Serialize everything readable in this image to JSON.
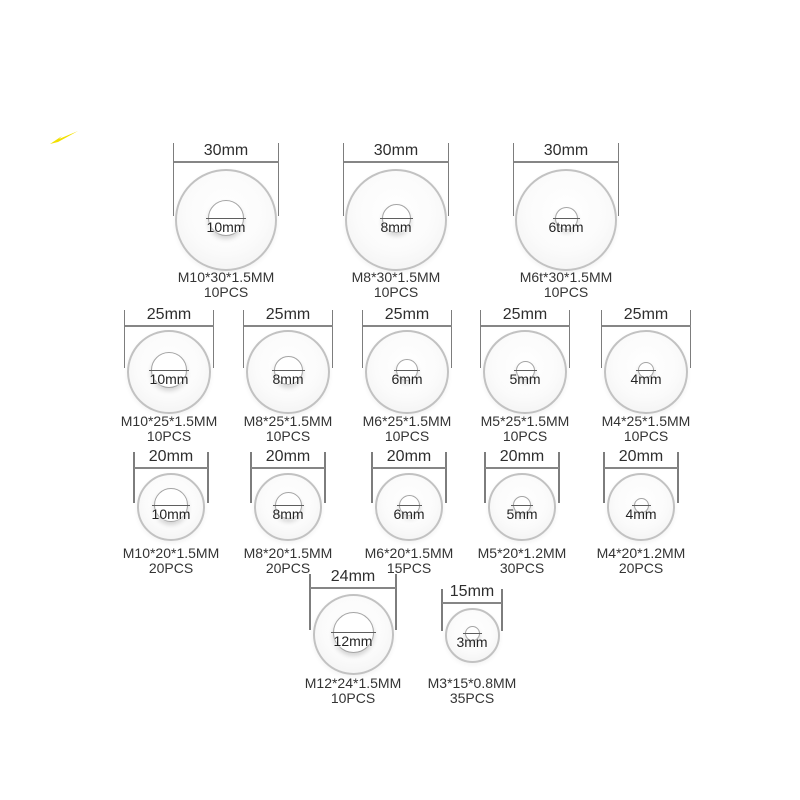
{
  "colors": {
    "background": "#ffffff",
    "washer_fill": "#f5f5f5",
    "washer_border": "#c2c2c2",
    "hole_border": "#a5a5a5",
    "dim_line": "#7d7d7d",
    "text": "#2e2e2e",
    "streak_yellow": "#f2e000"
  },
  "rows": [
    {
      "name": "30mm outer diameter washers",
      "washers": [
        {
          "outer_label": "30mm",
          "hole_label": "10mm",
          "spec": "M10*30*1.5MM",
          "qty": "10PCS"
        },
        {
          "outer_label": "30mm",
          "hole_label": "8mm",
          "spec": "M8*30*1.5MM",
          "qty": "10PCS"
        },
        {
          "outer_label": "30mm",
          "hole_label": "6tmm",
          "spec": "M6t*30*1.5MM",
          "qty": "10PCS"
        }
      ]
    },
    {
      "name": "25mm outer diameter washers",
      "washers": [
        {
          "outer_label": "25mm",
          "hole_label": "10mm",
          "spec": "M10*25*1.5MM",
          "qty": "10PCS"
        },
        {
          "outer_label": "25mm",
          "hole_label": "8mm",
          "spec": "M8*25*1.5MM",
          "qty": "10PCS"
        },
        {
          "outer_label": "25mm",
          "hole_label": "6mm",
          "spec": "M6*25*1.5MM",
          "qty": "10PCS"
        },
        {
          "outer_label": "25mm",
          "hole_label": "5mm",
          "spec": "M5*25*1.5MM",
          "qty": "10PCS"
        },
        {
          "outer_label": "25mm",
          "hole_label": "4mm",
          "spec": "M4*25*1.5MM",
          "qty": "10PCS"
        }
      ]
    },
    {
      "name": "20mm outer diameter washers",
      "washers": [
        {
          "outer_label": "20mm",
          "hole_label": "10mm",
          "spec": "M10*20*1.5MM",
          "qty": "20PCS"
        },
        {
          "outer_label": "20mm",
          "hole_label": "8mm",
          "spec": "M8*20*1.5MM",
          "qty": "20PCS"
        },
        {
          "outer_label": "20mm",
          "hole_label": "6mm",
          "spec": "M6*20*1.5MM",
          "qty": "15PCS"
        },
        {
          "outer_label": "20mm",
          "hole_label": "5mm",
          "spec": "M5*20*1.2MM",
          "qty": "30PCS"
        },
        {
          "outer_label": "20mm",
          "hole_label": "4mm",
          "spec": "M4*20*1.2MM",
          "qty": "20PCS"
        }
      ]
    },
    {
      "name": "bottom row washers",
      "washers": [
        {
          "outer_label": "24mm",
          "hole_label": "12mm",
          "spec": "M12*24*1.5MM",
          "qty": "10PCS"
        },
        {
          "outer_label": "15mm",
          "hole_label": "3mm",
          "spec": "M3*15*0.8MM",
          "qty": "35PCS"
        }
      ]
    }
  ]
}
